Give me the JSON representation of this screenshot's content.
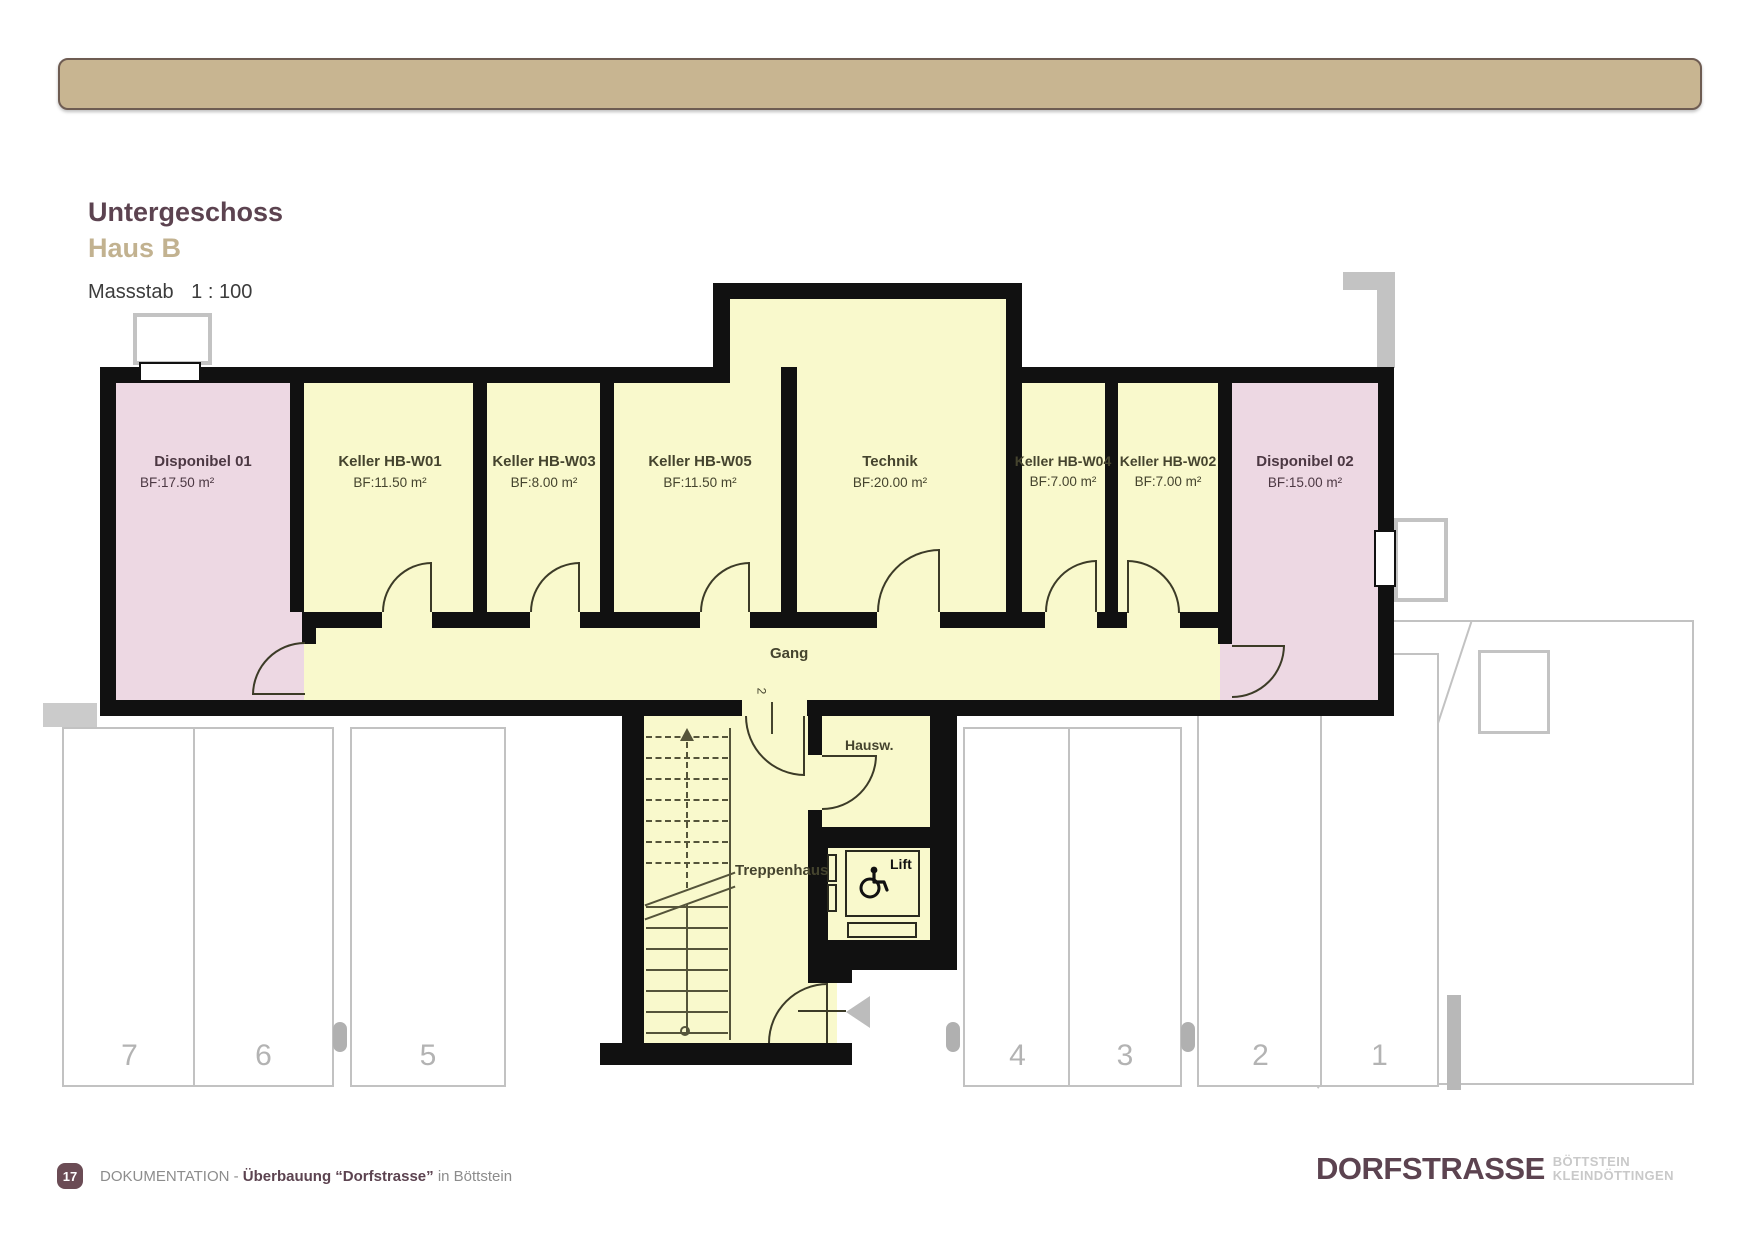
{
  "title": {
    "line1": "Untergeschoss",
    "line2": "Haus B",
    "scale_label": "Massstab",
    "scale_value": "1 : 100"
  },
  "plan": {
    "rooms": [
      {
        "name": "Disponibel 01",
        "area": "BF:17.50 m²"
      },
      {
        "name": "Keller HB-W01",
        "area": "BF:11.50 m²"
      },
      {
        "name": "Keller HB-W03",
        "area": "BF:8.00 m²"
      },
      {
        "name": "Keller HB-W05",
        "area": "BF:11.50 m²"
      },
      {
        "name": "Technik",
        "area": "BF:20.00 m²"
      },
      {
        "name": "Keller HB-W04",
        "area": "BF:7.00 m²"
      },
      {
        "name": "Keller HB-W02",
        "area": "BF:7.00 m²"
      },
      {
        "name": "Disponibel 02",
        "area": "BF:15.00 m²"
      }
    ],
    "corridor_label": "Gang",
    "stairwell_label": "Treppenhaus",
    "caretaker_label": "Hausw.",
    "lift_label": "Lift",
    "door_number": "2"
  },
  "parking": {
    "spaces": [
      "7",
      "6",
      "5",
      "4",
      "3",
      "2",
      "1"
    ]
  },
  "footer": {
    "page_number": "17",
    "doc_label": "DOKUMENTATION - ",
    "project": "Überbauung “Dorfstrasse”",
    "suffix": " in Böttstein"
  },
  "logo": {
    "main": "DORFSTRASSE",
    "sub_line1": "BÖTTSTEIN",
    "sub_line2": "KLEINDÖTTINGEN"
  },
  "colors": {
    "header_bar": "#c8b591",
    "header_border": "#6e5c52",
    "title_primary": "#5c4350",
    "title_secondary": "#c2b290",
    "room_yellow": "#f9f9cc",
    "room_pink": "#edd8e3",
    "wall": "#111111",
    "line_olive": "#3c3b27",
    "label_olive": "#45442e",
    "label_plum": "#4c3843",
    "cad_gray": "#c3c3c3",
    "parking_number": "#b3b3b3",
    "footer_text": "#8c8c8c"
  }
}
